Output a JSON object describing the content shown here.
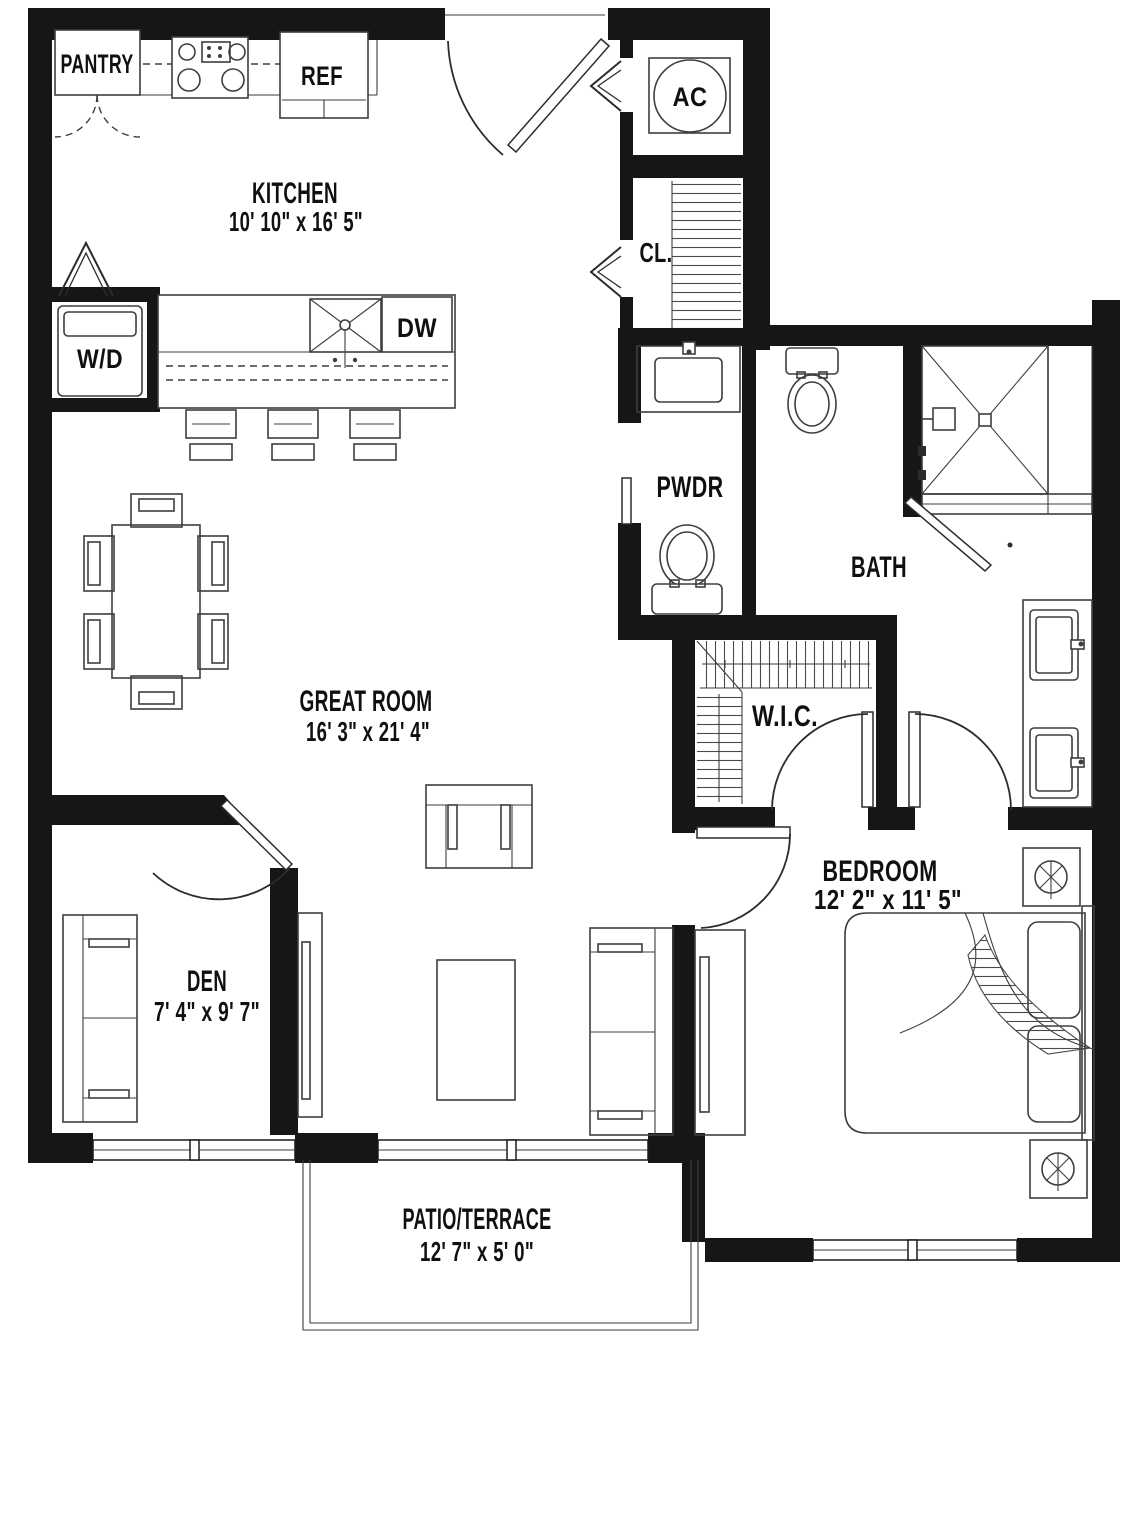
{
  "rooms": {
    "kitchen": {
      "name": "KITCHEN",
      "dims": "10' 10\" x 16' 5\""
    },
    "great_room": {
      "name": "GREAT ROOM",
      "dims": "16' 3\" x 21' 4\""
    },
    "den": {
      "name": "DEN",
      "dims": "7' 4\" x 9' 7\""
    },
    "bedroom": {
      "name": "BEDROOM",
      "dims": "12' 2\" x 11' 5\""
    },
    "patio": {
      "name": "PATIO/TERRACE",
      "dims": "12' 7\" x 5' 0\""
    },
    "bath": {
      "name": "BATH"
    },
    "pwdr": {
      "name": "PWDR"
    },
    "wic": {
      "name": "W.I.C."
    },
    "closet": {
      "name": "CL."
    }
  },
  "fixtures": {
    "pantry": "PANTRY",
    "ref": "REF",
    "wd": "W/D",
    "dw": "DW",
    "ac": "AC"
  },
  "colors": {
    "wall": "#161616",
    "line": "#3e3e3e",
    "bg": "#ffffff"
  }
}
